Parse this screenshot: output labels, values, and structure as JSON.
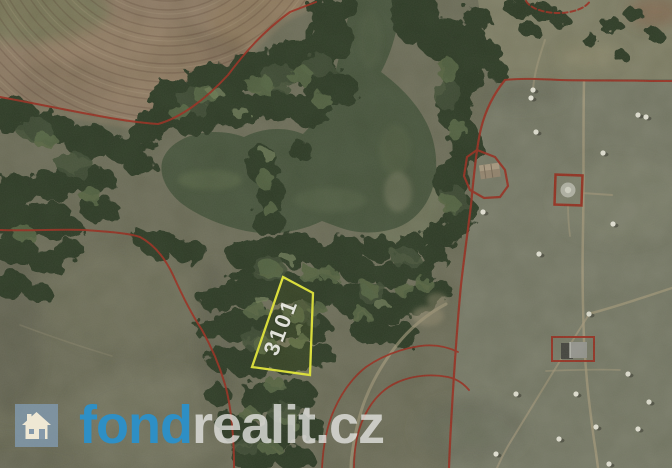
{
  "parcel": {
    "number": "3101",
    "outline_color": "#e6e93b"
  },
  "boundaries": {
    "line_color": "#9e3325"
  },
  "logo": {
    "fond": "fond",
    "realit": "realit.cz",
    "fond_color": "#2e8fc5",
    "realit_color": "#e6e6e3",
    "icon": "house-icon",
    "icon_bg": "#8298aa"
  }
}
